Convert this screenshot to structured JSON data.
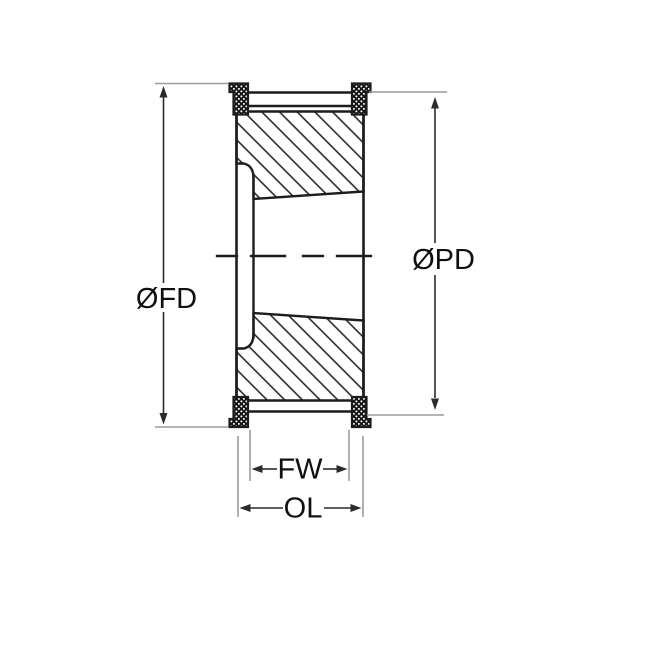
{
  "diagram": {
    "type": "technical-drawing",
    "subject": "timing-pulley-cross-section-with-taper-bore",
    "labels": {
      "flange_diameter": "ØFD",
      "pitch_diameter": "ØPD",
      "face_width": "FW",
      "overall_length": "OL"
    },
    "colors": {
      "outline": "#1c1c1c",
      "extension_line": "#9c9c9c",
      "dimension_line": "#2b2b2b",
      "label_text": "#101010",
      "background": "#ffffff"
    }
  }
}
